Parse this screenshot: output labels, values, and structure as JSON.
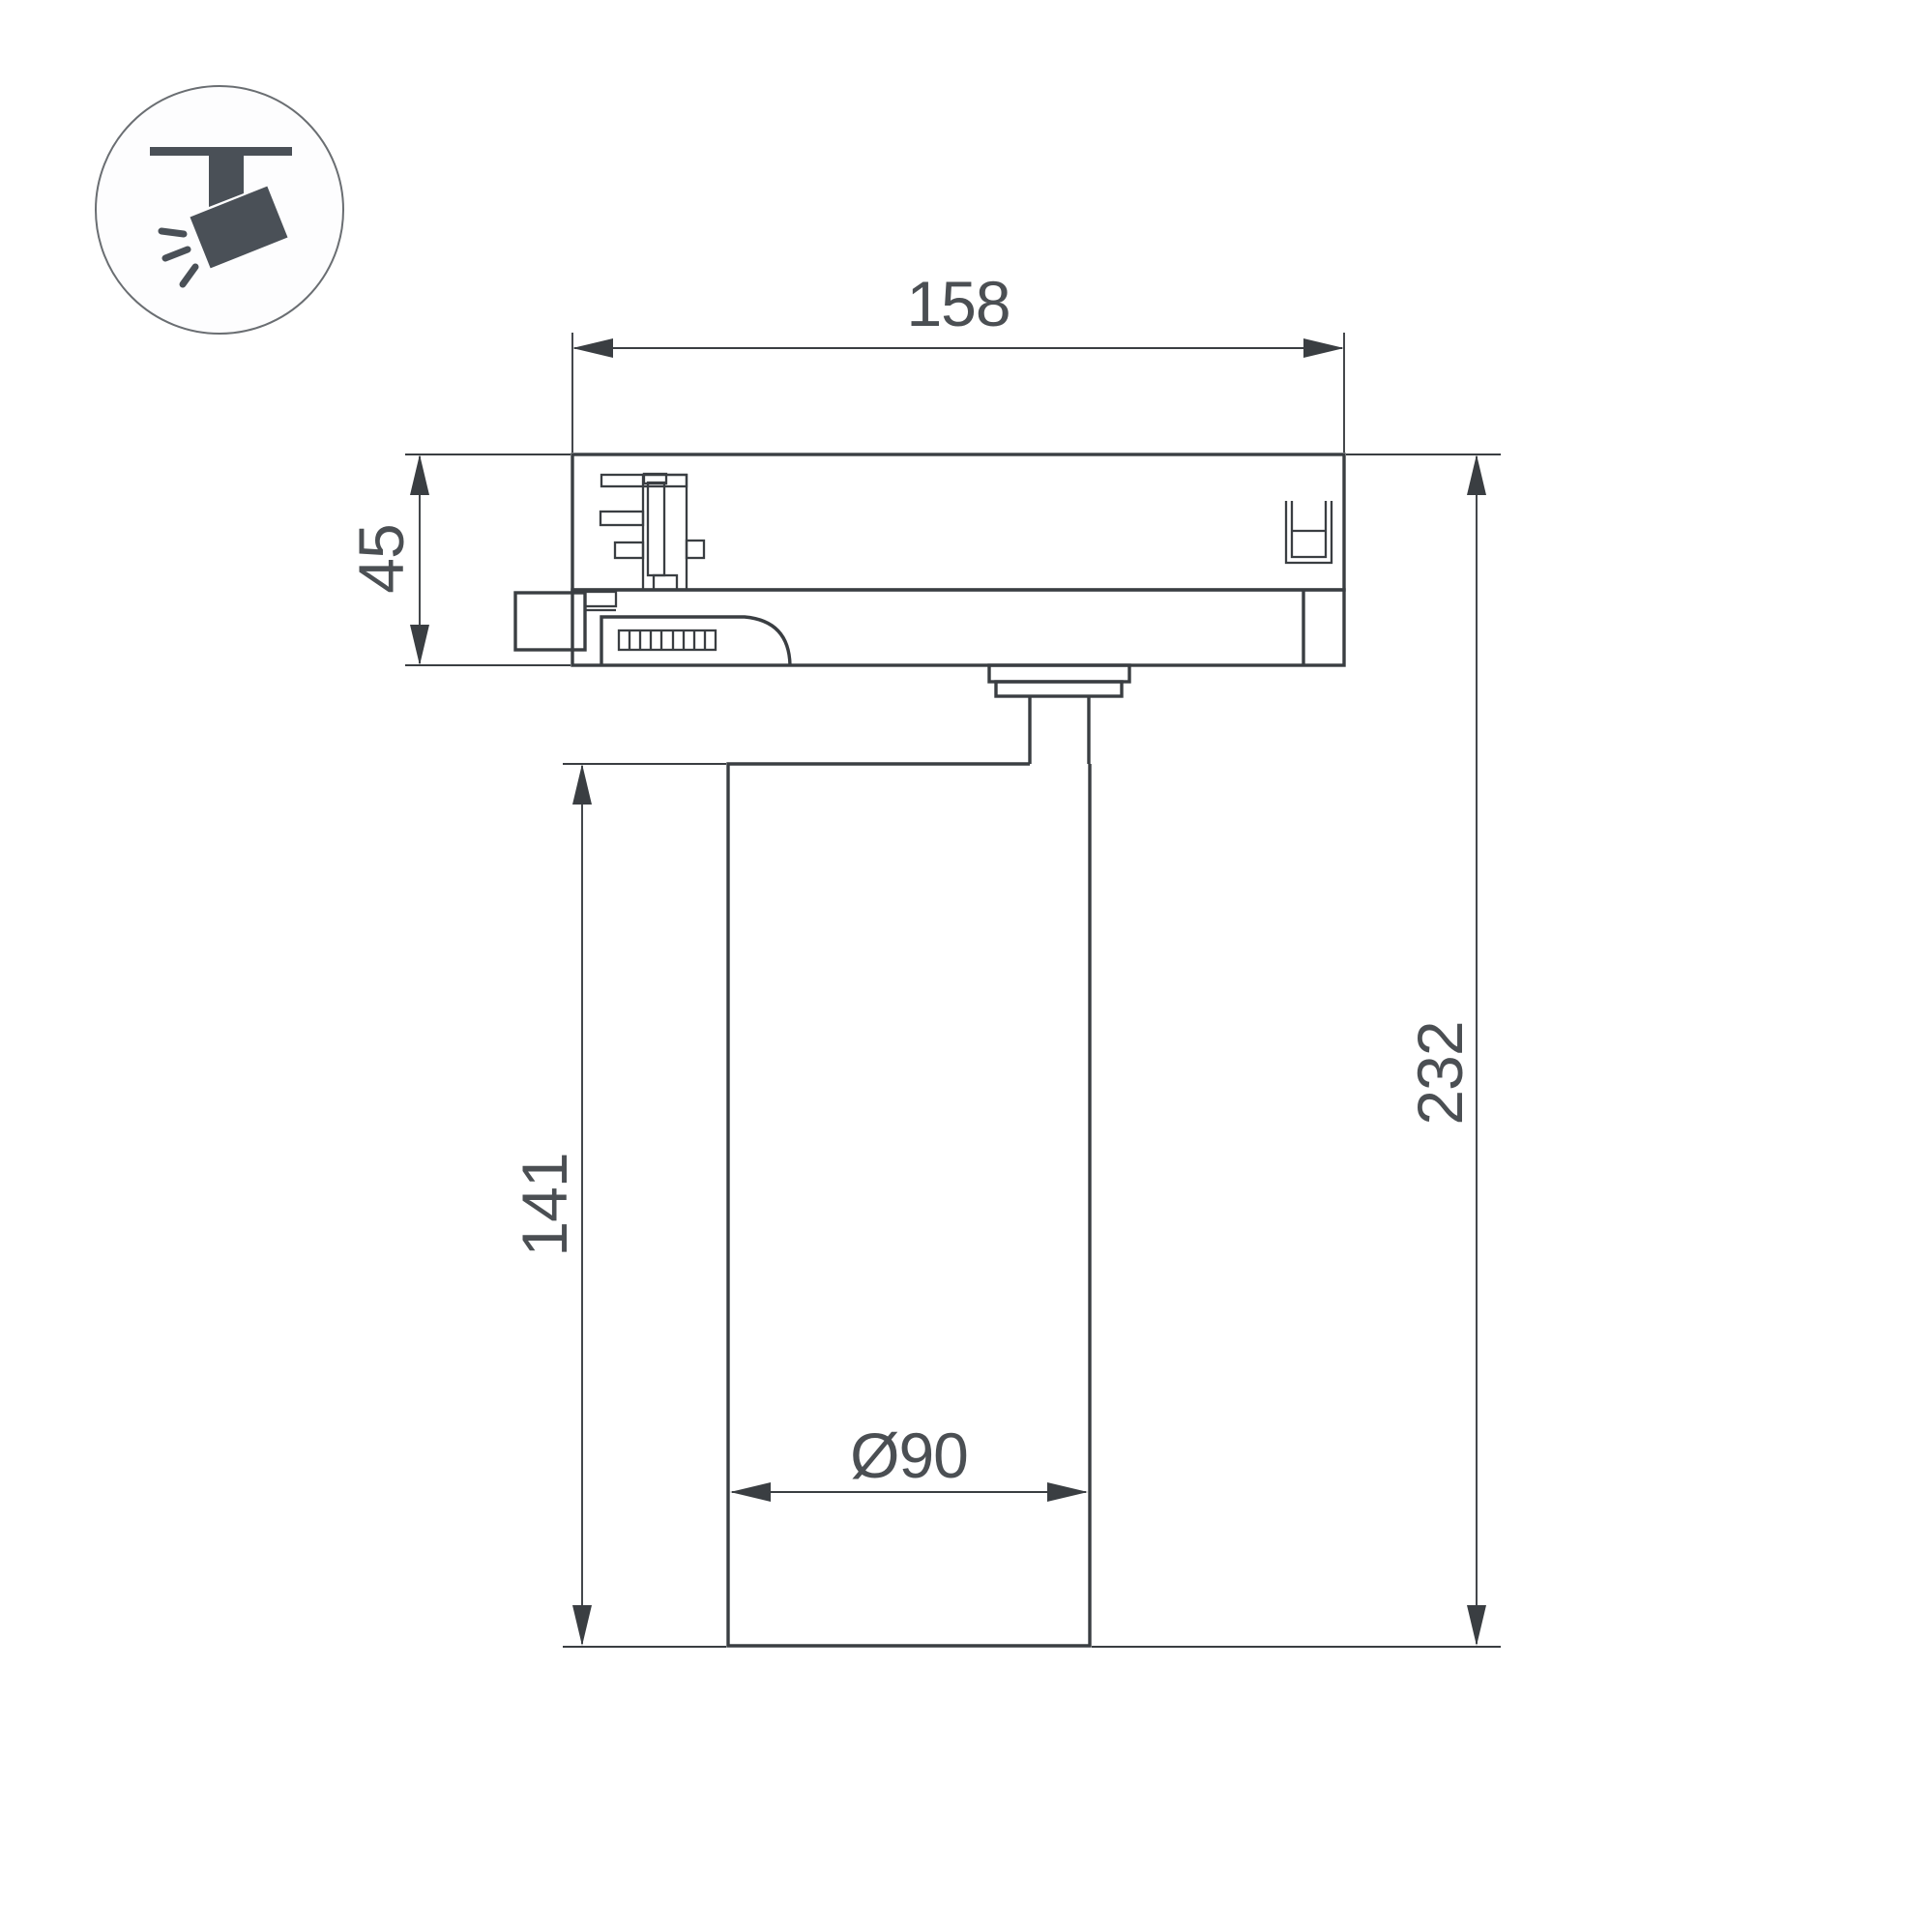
{
  "theme": {
    "background": "#ffffff",
    "line_color": "#3a3e42",
    "label_color": "#4b4f53",
    "icon_color": "#4a5057",
    "icon_circle_stroke": "#6a6e72"
  },
  "icon": {
    "name": "track-mounted-spotlight"
  },
  "dimensions": {
    "width": {
      "label": "158"
    },
    "adapter_height": {
      "label": "45"
    },
    "body_height": {
      "label": "141"
    },
    "total_height": {
      "label": "232"
    },
    "diameter": {
      "label": "Ø90"
    }
  }
}
